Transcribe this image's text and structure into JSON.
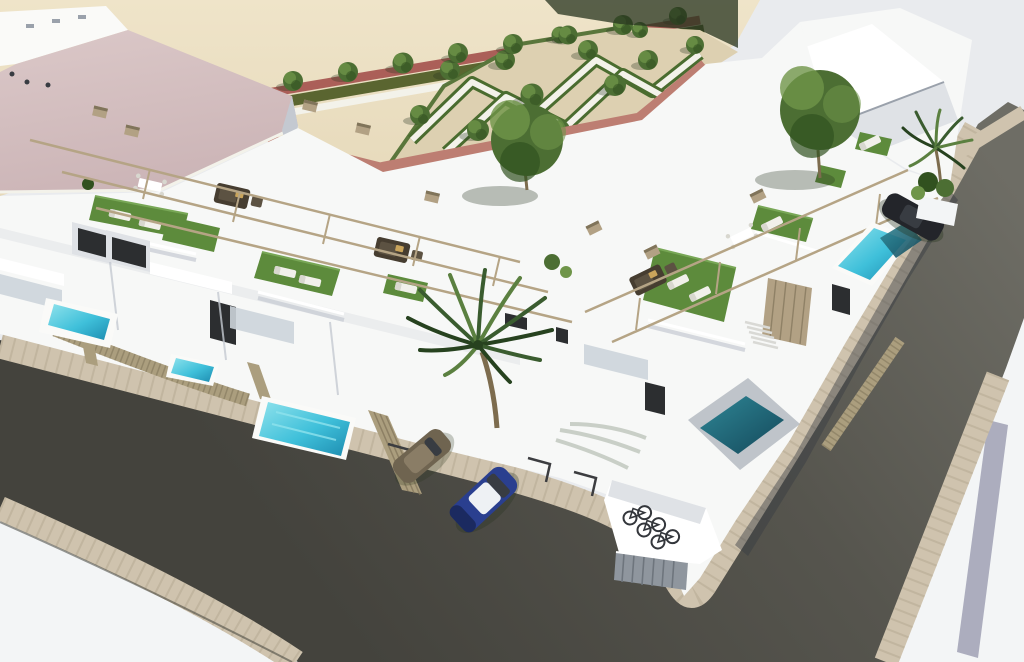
{
  "scene": {
    "type": "3d-architectural-render",
    "view": "aerial-corner",
    "subject": "White modern townhouse development with rooftop terraces, private pools, parterre park and corner streets"
  },
  "inventory": {
    "private_pools": 6,
    "parked_cars": 3,
    "bicycles": 3,
    "palm_trees": 2,
    "street_trees": 11,
    "park_trees": 14,
    "roof_turf_terraces": 8,
    "sun_loungers": 9,
    "wicker_lounge_sets": 3,
    "dining_sets": 2
  },
  "palette": {
    "bg": "#e9ebee",
    "sand": "#e6d9ba",
    "sand_light": "#efe4c9",
    "gravel": "#ddd0b1",
    "path_white": "#f3f2ea",
    "hedge": "#4a6c2f",
    "hedge_dark": "#3a5724",
    "tree": "#4c6e33",
    "tree_light": "#6f9549",
    "tree_dark": "#31511f",
    "trunk": "#7d6c4e",
    "veg_shadow": "#26331d",
    "pink_path": "#bd7e72",
    "red_path": "#ab5f58",
    "verge": "#5a6530",
    "pink_roof": "#dbc8c8",
    "pink_roof_dark": "#ccb5b7",
    "white": "#ffffff",
    "near_white": "#fafaf8",
    "bldg": "#f7f8f7",
    "shade1": "#dfe2e6",
    "shade2": "#c4c9d1",
    "shade3": "#9aa1ab",
    "window": "#2c2e30",
    "glassline": "#b7c0c8",
    "frosted": "#ccd4da",
    "fence": "#ab9e7e",
    "fence_dark": "#80745a",
    "cladding": "#b2a184",
    "turf": "#5d8b3c",
    "turf_light": "#78a756",
    "lounger": "#f1f0ea",
    "lounger_shade": "#d8d7cf",
    "wicker": "#463d30",
    "wicker_light": "#5c5242",
    "cushion": "#c9a45b",
    "pergola": "#b5a485",
    "asphalt": "#56554e",
    "asphalt_light": "#6e6d65",
    "asphalt_dark": "#44433d",
    "cobble": "#cfc3ae",
    "cobble_line": "#b3a78f",
    "ground_white": "#f3f5f6",
    "lavender": "#9fa0b4",
    "pool1": "#8fe2ec",
    "pool2": "#3fc0da",
    "pool3": "#1d8cb0",
    "teal1": "#2f8796",
    "teal2": "#14485a",
    "car_blue": "#2a3f8f",
    "car_blue_dark": "#1b2a60",
    "car_roof": "#eef1f4",
    "car_brown": "#6f6450",
    "car_brown_light": "#8a7d66",
    "car_black": "#23252a",
    "car_glass": "#383c42",
    "bike": "#33363b",
    "gate": "#8f969e",
    "gate_dark": "#6e757d",
    "stair": "#d9d9d5",
    "marking": "#3c3d40",
    "palm1": "#3a5c2f",
    "palm2": "#5b8040",
    "palm3": "#27421f",
    "curb": "#3f3f39"
  }
}
